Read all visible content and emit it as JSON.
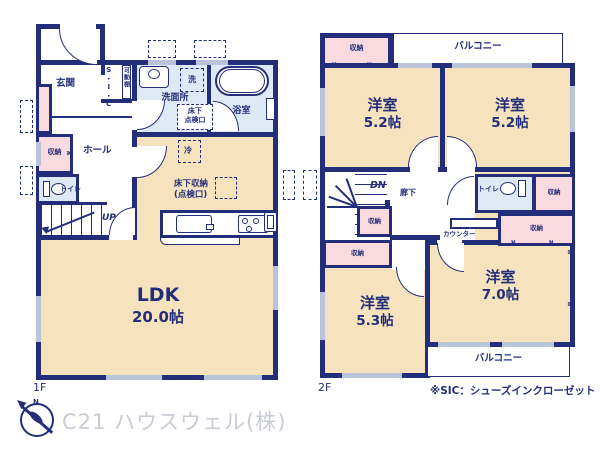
{
  "common": {
    "storage": "収納",
    "toilet": "トイレ",
    "balcony": "バルコニー",
    "western_room": "洋室"
  },
  "f1": {
    "floor_label": "1F",
    "entrance": "玄関",
    "sic": "S・I・C",
    "movable_shelf": "可動棚",
    "washroom": "洗面所",
    "washer": "洗",
    "bathroom": "浴室",
    "underfloor_access_l1": "床下",
    "underfloor_access_l2": "点検口",
    "hall": "ホール",
    "up": "UP",
    "fridge": "冷",
    "underfloor_storage_l1": "床下収納",
    "underfloor_storage_l2": "(点検口)",
    "ldk": "LDK",
    "ldk_size": "20.0帖"
  },
  "f2": {
    "floor_label": "2F",
    "dn": "DN",
    "corridor": "廊下",
    "counter": "カウンター",
    "size_52": "5.2帖",
    "size_53": "5.3帖",
    "size_70": "7.0帖"
  },
  "footer": {
    "company": "C21 ハウスウェル(株)",
    "sic_note": "※SIC：シューズインクローゼット"
  },
  "compass": {
    "north": "N"
  },
  "colors": {
    "wall": "#232e7b",
    "room": "#f6e3bd",
    "closet": "#f9dade",
    "wet": "#dde9f4",
    "window": "#b9c3d9",
    "watermark": "#c9cbd4"
  }
}
